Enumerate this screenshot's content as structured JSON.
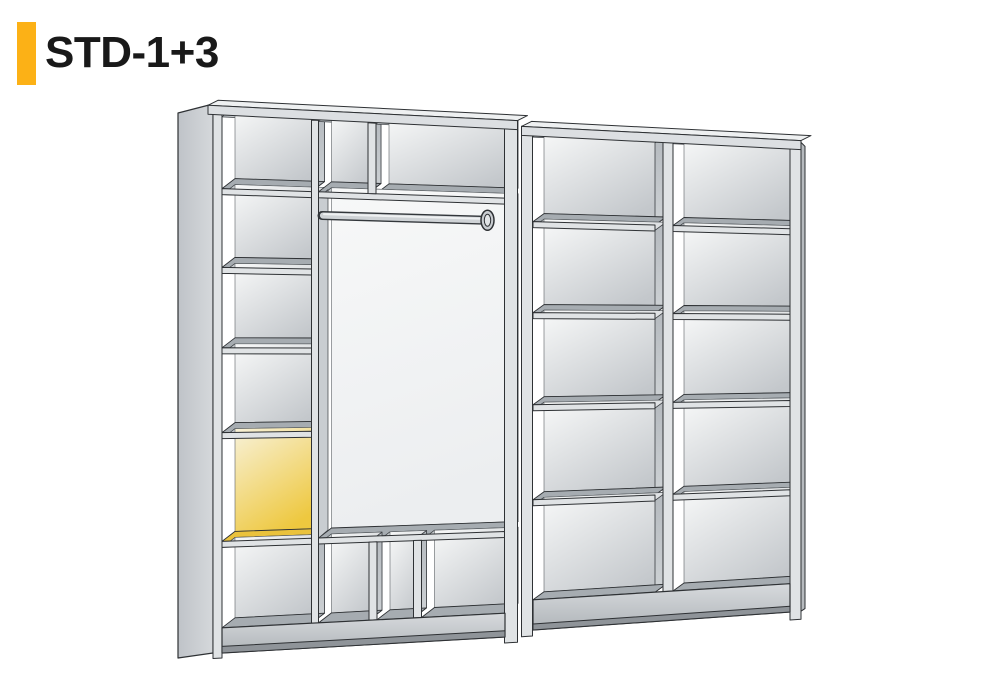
{
  "header": {
    "title": "STD-1+3"
  },
  "colors": {
    "accent": "#FCB116",
    "title_text": "#191919",
    "outline": "#2e3134",
    "line_soft": "#3a3e42",
    "edge_strip": "#e0e3e5",
    "cap_strip": "#dcdfe2",
    "cap_top": "#eef0f1",
    "ceiling": "#c6cacd",
    "shelf_top": "#a6acb1",
    "back_top": "#f8f9f9",
    "back_bottom": "#c3c7cb",
    "wall_top": "#b4b9be",
    "wall_bottom": "#ced2d5",
    "side_face_back": "#bfc3c8",
    "side_face_front": "#d5d8db",
    "plinth_top": "#d7dadd",
    "plinth_bottom": "#b0b5b9",
    "plinth_band": "#8f9499",
    "white_panel_top": "#f7f8f8",
    "white_panel_bottom": "#eceef0",
    "sliver_wall": "#c9cdd1",
    "highlight_floor": "#EAC23C",
    "highlight_back_top": "#F8F2DA",
    "highlight_back_bottom": "#EEC83F",
    "highlight_wall_top": "#EAC44D",
    "highlight_wall_bottom": "#DFAF2C",
    "rod_outline": "#33373b",
    "rod_body": "#cfd3d6",
    "rod_highlight": "#eff1f2",
    "background": "#ffffff"
  },
  "diagram": {
    "name": "wardrobe-configuration",
    "units": [
      {
        "id": "unit-1",
        "type": "wardrobe",
        "left_column_compartments": 6,
        "highlighted_compartment_index": 5,
        "top_compartments": 2,
        "hanging_rod": true,
        "bottom_compartments": 3
      },
      {
        "id": "unit-2",
        "type": "open-shelving",
        "columns": 2,
        "rows_per_column": 5
      }
    ]
  }
}
